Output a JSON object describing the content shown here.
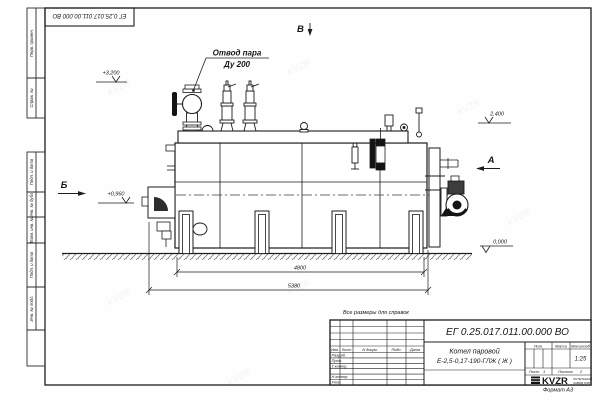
{
  "sheet": {
    "stamp_top": "ЕГ 0.25.017.011.00.000  ВО",
    "format_note": "Формат  А3",
    "margin_labels": [
      "Перв. примен.",
      "Справ. №",
      "Подп. и дата",
      "Инв. № дубл.",
      "Взам. инв. №",
      "Подп. и дата",
      "Инв. № подл."
    ]
  },
  "drawing": {
    "callout": {
      "line1": "Отвод пара",
      "line2": "Ду 200"
    },
    "elevations": {
      "top": "+3,200",
      "right_upper": "2,400",
      "left_mid": "+0,960",
      "ground": "0,000"
    },
    "views": {
      "top": "В",
      "right": "А",
      "left": "Б"
    },
    "dimensions": {
      "inner": "4800",
      "overall": "5380"
    },
    "note": "Все размеры для справок",
    "watermark": "KVZR"
  },
  "title_block": {
    "doc_number": "ЕГ 0.25.017.011.00.000  ВО",
    "product_name_line1": "Котел паровой",
    "product_name_line2": "Е-2,5-0,17-190-ГЛЖ ( Ж )",
    "cols": [
      "Изм.",
      "Лист",
      "N докум.",
      "Подп.",
      "Дата"
    ],
    "rows": [
      "Разраб.",
      "Пров.",
      "Т.контр.",
      "Н.контр.",
      "Утв."
    ],
    "lit_label": "Лит.",
    "mass_label": "Масса",
    "scale_label": "Масштаб",
    "scale_value": "1:25",
    "sheet_label": "Лист",
    "sheet_value": "1",
    "sheets_label": "Листов",
    "sheets_value": "2",
    "logo_text": "KVZR",
    "org_line1": "КОТЕЛЬНЫЙ",
    "org_line2": "ЗАВОД РЭП"
  }
}
